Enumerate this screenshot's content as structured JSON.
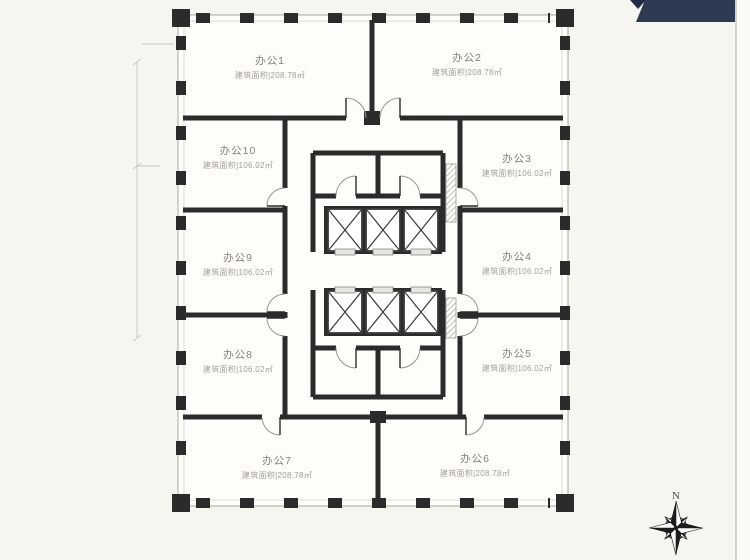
{
  "page": {
    "background": "#f7f5ef",
    "plan_fill": "#fefdfa",
    "wall_color": "#2b2b2b",
    "ribbon_color": "#2e3a52",
    "compass_color": "#1c1c1c"
  },
  "units": [
    {
      "name": "办公1",
      "area": "建筑面积|208.78㎡"
    },
    {
      "name": "办公2",
      "area": "建筑面积|208.78㎡"
    },
    {
      "name": "办公3",
      "area": "建筑面积|106.02㎡"
    },
    {
      "name": "办公4",
      "area": "建筑面积|106.02㎡"
    },
    {
      "name": "办公5",
      "area": "建筑面积|106.02㎡"
    },
    {
      "name": "办公6",
      "area": "建筑面积|208.78㎡"
    },
    {
      "name": "办公7",
      "area": "建筑面积|208.78㎡"
    },
    {
      "name": "办公8",
      "area": "建筑面积|106.02㎡"
    },
    {
      "name": "办公9",
      "area": "建筑面积|106.02㎡"
    },
    {
      "name": "办公10",
      "area": "建筑面积|106.02㎡"
    }
  ],
  "compass": {
    "north_label": "N"
  }
}
